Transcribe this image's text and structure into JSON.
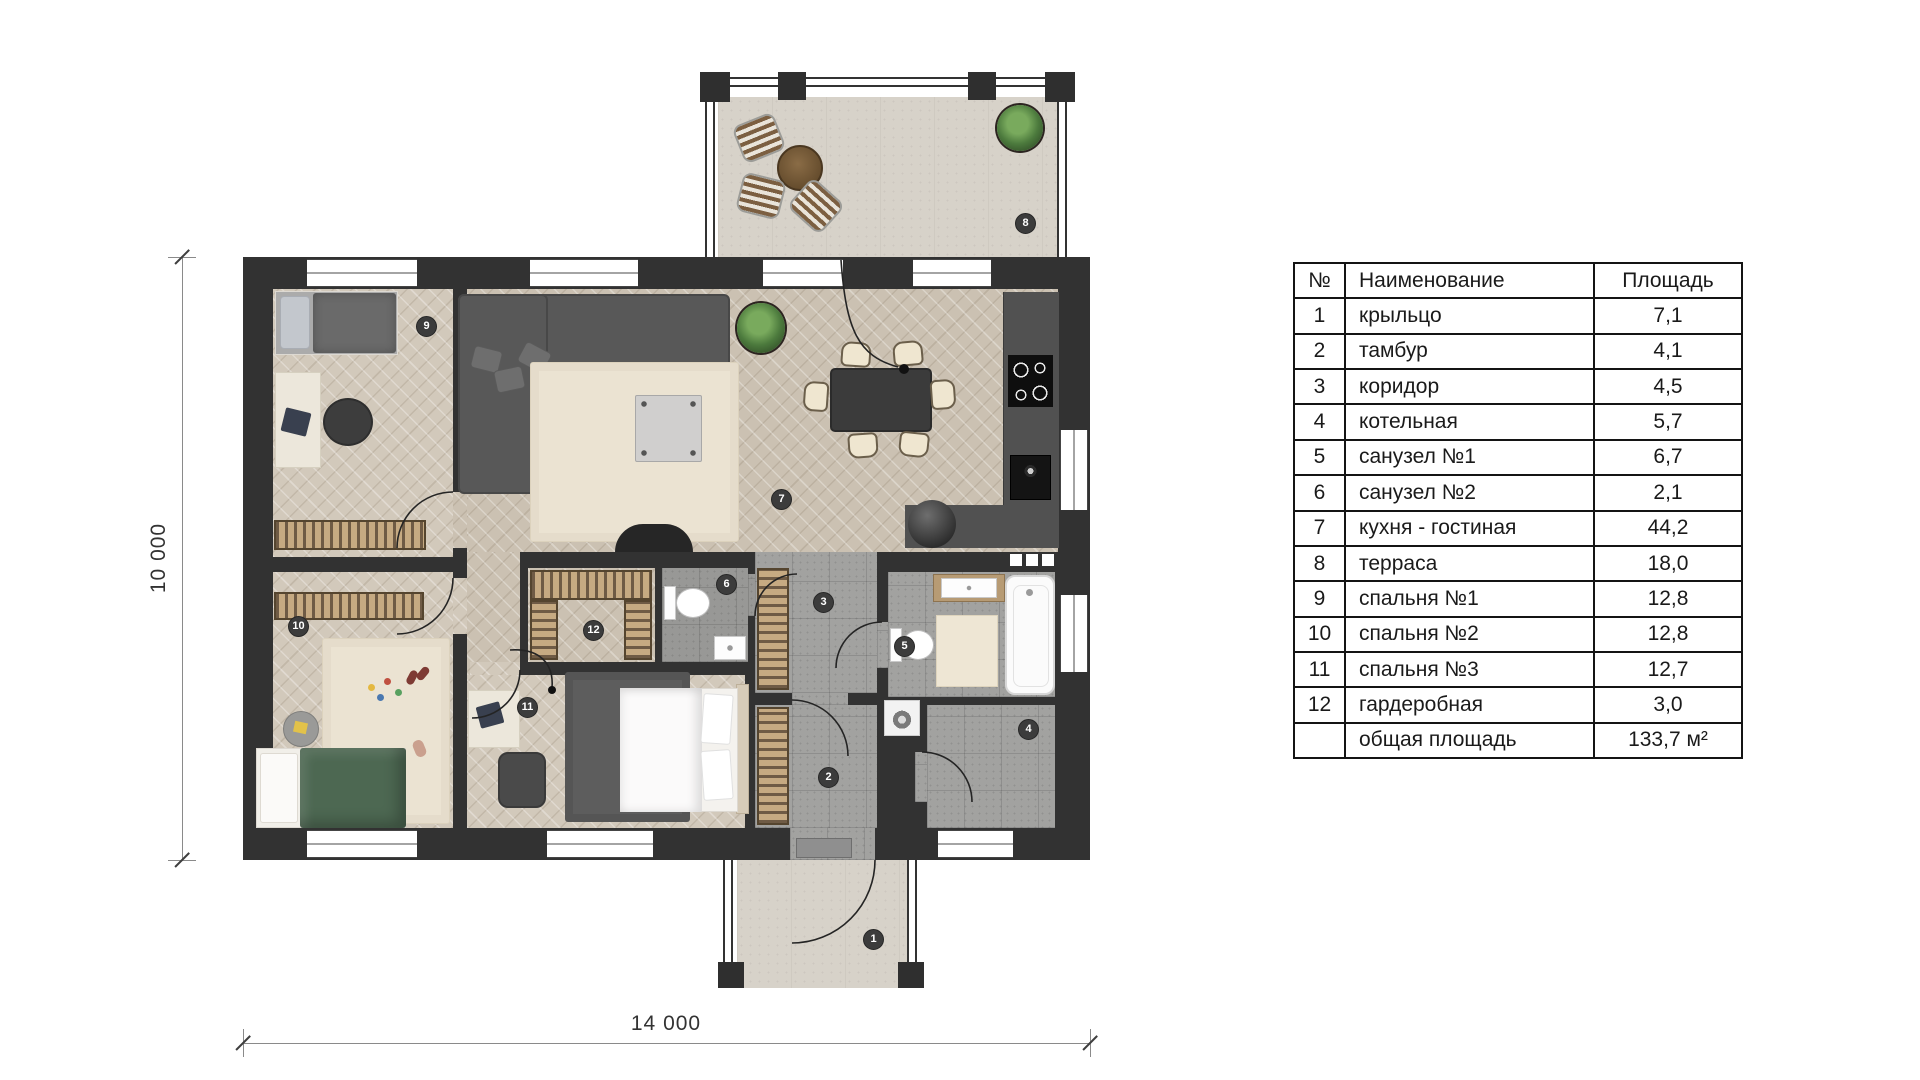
{
  "legend_table": {
    "headers": {
      "num": "№",
      "name": "Наименование",
      "area": "Площадь"
    },
    "rows": [
      {
        "num": "1",
        "name": "крыльцо",
        "area": "7,1"
      },
      {
        "num": "2",
        "name": "тамбур",
        "area": "4,1"
      },
      {
        "num": "3",
        "name": "коридор",
        "area": "4,5"
      },
      {
        "num": "4",
        "name": "котельная",
        "area": "5,7"
      },
      {
        "num": "5",
        "name": "санузел №1",
        "area": "6,7"
      },
      {
        "num": "6",
        "name": "санузел №2",
        "area": "2,1"
      },
      {
        "num": "7",
        "name": "кухня - гостиная",
        "area": "44,2"
      },
      {
        "num": "8",
        "name": "терраса",
        "area": "18,0"
      },
      {
        "num": "9",
        "name": "спальня №1",
        "area": "12,8"
      },
      {
        "num": "10",
        "name": "спальня №2",
        "area": "12,8"
      },
      {
        "num": "11",
        "name": "спальня №3",
        "area": "12,7"
      },
      {
        "num": "12",
        "name": "гардеробная",
        "area": "3,0"
      },
      {
        "num": "",
        "name": "общая площадь",
        "area": "133,7 м²"
      }
    ]
  },
  "rooms": [
    {
      "number": "1",
      "name": "крыльцо"
    },
    {
      "number": "2",
      "name": "тамбур"
    },
    {
      "number": "3",
      "name": "коридор"
    },
    {
      "number": "4",
      "name": "котельная"
    },
    {
      "number": "5",
      "name": "санузел №1"
    },
    {
      "number": "6",
      "name": "санузел №2"
    },
    {
      "number": "7",
      "name": "кухня - гостиная"
    },
    {
      "number": "8",
      "name": "терраса"
    },
    {
      "number": "9",
      "name": "спальня №1"
    },
    {
      "number": "10",
      "name": "спальня №2"
    },
    {
      "number": "11",
      "name": "спальня №3"
    },
    {
      "number": "12",
      "name": "гардеробная"
    }
  ],
  "dimensions": {
    "vertical": "10 000",
    "horizontal": "14 000"
  },
  "colors": {
    "wall": "#323232",
    "parquet": "#cbc1b2",
    "tile": "#a2a2a0",
    "deck": "#d7d2c9",
    "accent_green": "#4d6852"
  }
}
